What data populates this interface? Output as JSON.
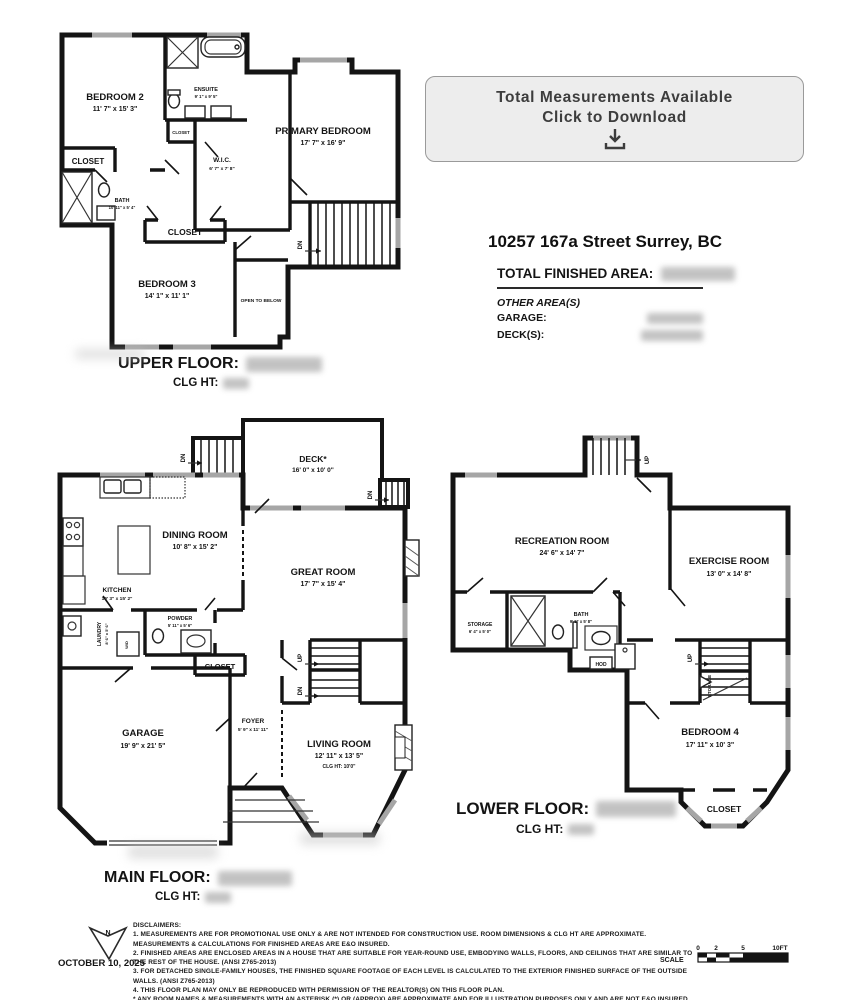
{
  "button": {
    "line1": "Total Measurements Available",
    "line2": "Click to Download"
  },
  "property": {
    "address": "10257 167a Street Surrey, BC",
    "total_label": "TOTAL FINISHED AREA:",
    "other_label": "OTHER AREA(S)",
    "garage_label": "GARAGE:",
    "decks_label": "DECK(S):"
  },
  "floors": {
    "upper": {
      "title": "UPPER FLOOR:",
      "clg": "CLG HT:",
      "rooms": {
        "bedroom2": {
          "n": "BEDROOM 2",
          "d": "11' 7\" x 15' 3\""
        },
        "ensuite": {
          "n": "ENSUITE",
          "d": "9' 1\" x 9' 5\""
        },
        "closet_left": "CLOSET",
        "closet_small": "CLOSET",
        "closet_mid": "CLOSET",
        "bath": {
          "n": "BATH",
          "d": "10' 11\" x 5' 4\""
        },
        "wic": {
          "n": "W.I.C.",
          "d": "6' 7\" x 7' 8\""
        },
        "primary": {
          "n": "PRIMARY BEDROOM",
          "d": "17' 7\" x 16' 9\""
        },
        "bedroom3": {
          "n": "BEDROOM 3",
          "d": "14' 1\" x 11' 1\""
        },
        "open_below": "OPEN TO BELOW",
        "dn": "DN"
      }
    },
    "main": {
      "title": "MAIN FLOOR:",
      "clg": "CLG HT:",
      "rooms": {
        "deck": {
          "n": "DECK*",
          "d": "16' 0\" x 10' 0\""
        },
        "dining": {
          "n": "DINING ROOM",
          "d": "10' 8\" x 15' 2\""
        },
        "kitchen": {
          "n": "KITCHEN",
          "d": "10' 3\" x 15' 2\""
        },
        "great": {
          "n": "GREAT ROOM",
          "d": "17' 7\" x 15' 4\""
        },
        "laundry": {
          "n": "LAUNDRY",
          "d": "8' 6\" x 5' 6\""
        },
        "powder": {
          "n": "POWDER",
          "d": "5' 11\" x 5' 6\""
        },
        "closet": "CLOSET",
        "garage": {
          "n": "GARAGE",
          "d": "19' 9\" x 21' 5\""
        },
        "foyer": {
          "n": "FOYER",
          "d": "5' 9\" x 11' 11\""
        },
        "living": {
          "n": "LIVING ROOM",
          "d": "12' 11\" x 13' 5\"",
          "c": "CLG HT:  10'0\""
        },
        "wd": "W/D",
        "up": "UP",
        "dn": "DN"
      }
    },
    "lower": {
      "title": "LOWER FLOOR:",
      "clg": "CLG HT:",
      "rooms": {
        "rec": {
          "n": "RECREATION ROOM",
          "d": "24' 6\" x 14' 7\""
        },
        "exercise": {
          "n": "EXERCISE ROOM",
          "d": "13' 0\" x 14' 8\""
        },
        "storage": {
          "n": "STORAGE",
          "d": "6' 4\" x 5' 0\""
        },
        "bath": {
          "n": "BATH",
          "d": "9' 5\" x 5' 8\""
        },
        "hod": "HOD",
        "storage_under": "STORAGE",
        "bedroom4": {
          "n": "BEDROOM 4",
          "d": "17' 11\" x 10' 3\""
        },
        "closet": "CLOSET",
        "up": "UP"
      }
    }
  },
  "footer": {
    "date": "OCTOBER 10, 2025",
    "north": "N",
    "scale_label": "SCALE",
    "ticks": [
      "0",
      "2",
      "5",
      "10FT"
    ],
    "disclaimers": [
      "DISCLAIMERS:",
      "1. MEASUREMENTS ARE FOR PROMOTIONAL USE ONLY & ARE NOT INTENDED FOR CONSTRUCTION USE. ROOM DIMENSIONS & CLG HT ARE APPROXIMATE. MEASUREMENTS & CALCULATIONS FOR FINISHED AREAS ARE E&O INSURED.",
      "2. FINISHED AREAS ARE ENCLOSED AREAS IN A HOUSE THAT ARE SUITABLE FOR YEAR-ROUND USE, EMBODYING WALLS, FLOORS, AND CEILINGS THAT ARE SIMILAR TO THE REST OF THE HOUSE. (ANSI Z765-2013)",
      "3. FOR DETACHED SINGLE-FAMILY HOUSES, THE FINISHED SQUARE FOOTAGE OF EACH LEVEL IS CALCULATED TO THE EXTERIOR FINISHED SURFACE OF THE OUTSIDE WALLS. (ANSI Z765-2013)",
      "4. THIS FLOOR PLAN MAY ONLY BE REPRODUCED WITH PERMISSION OF THE REALTOR(S) ON THIS FLOOR PLAN.",
      "* ANY ROOM NAMES & MEASUREMENTS WITH AN ASTERISK (*) OR (APPROX) ARE APPROXIMATE AND FOR ILLUSTRATION PURPOSES ONLY AND ARE NOT E&O INSURED."
    ]
  }
}
